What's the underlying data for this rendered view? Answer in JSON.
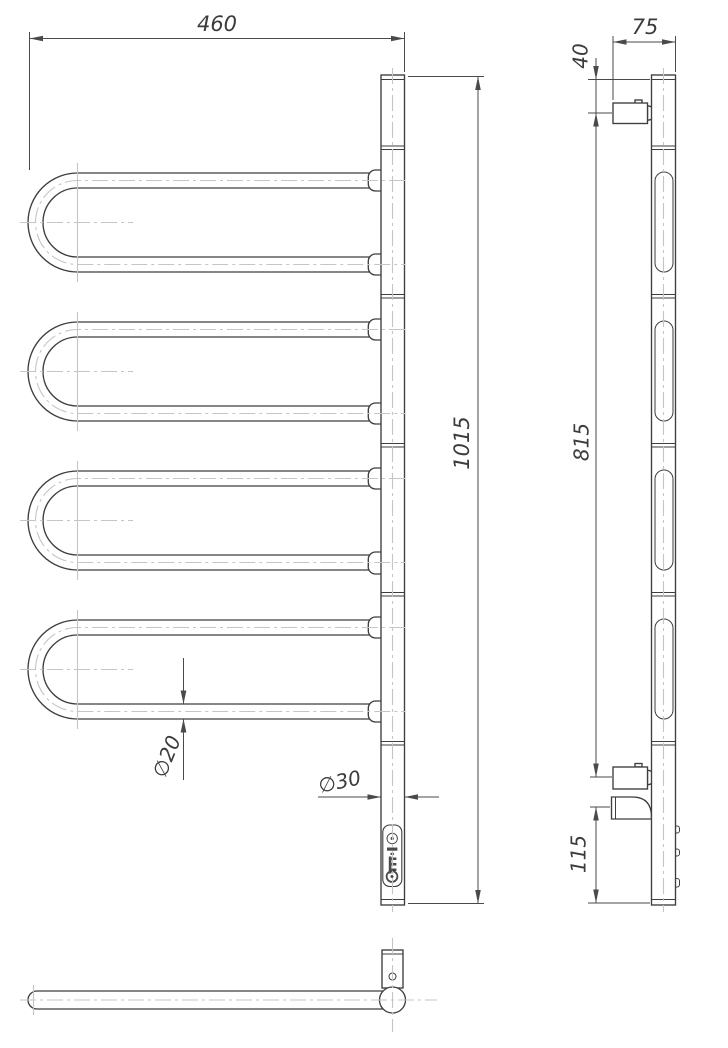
{
  "drawing": {
    "type": "technical-orthographic-drawing",
    "subject": "heated towel rail with four swivel U-shaped arms",
    "dimensions": {
      "front_width": "460",
      "front_height": "1015",
      "tube_diameter": "∅20",
      "post_diameter": "∅30",
      "side_depth": "75",
      "side_top_offset": "40",
      "side_span": "815",
      "side_bottom_offset": "115"
    },
    "icons": {
      "logo_icon": "control-panel-logo"
    },
    "colors": {
      "line": "#3e3e3e",
      "dimension": "#4a4a4a",
      "centerline": "#c5c5c5",
      "background": "#ffffff"
    }
  }
}
